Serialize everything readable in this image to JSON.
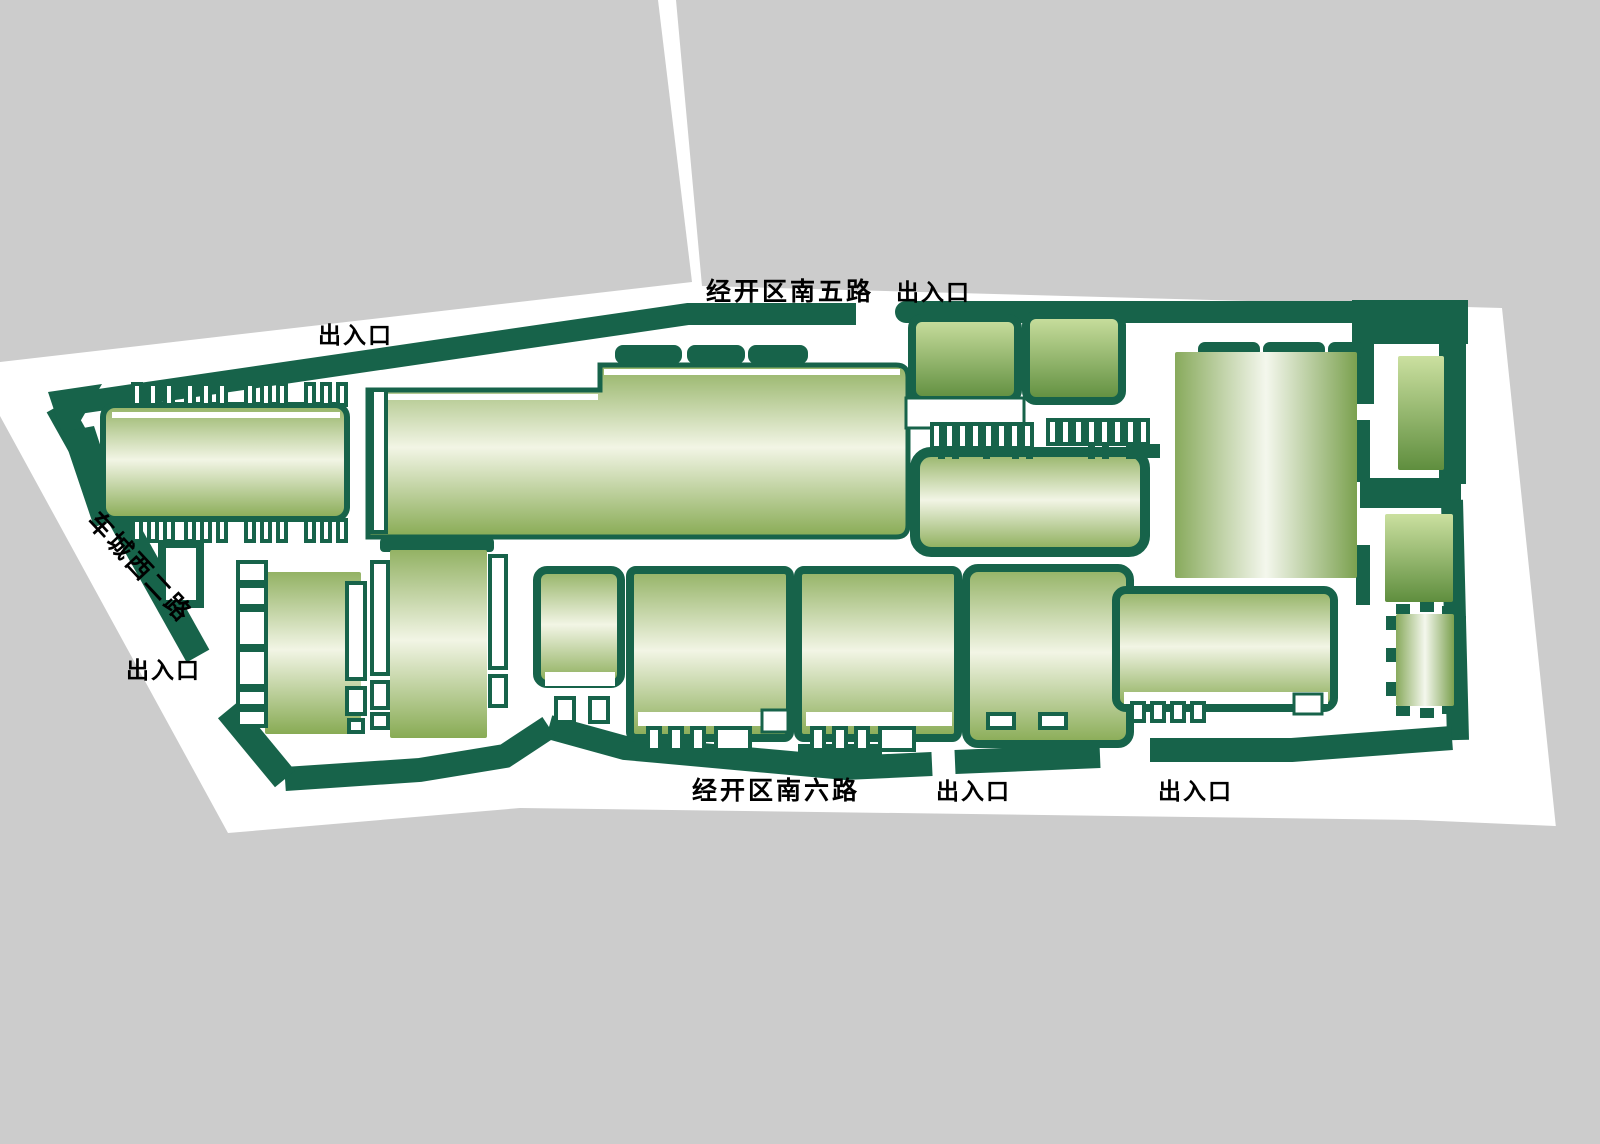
{
  "map": {
    "title": "industrial-park-site-plan",
    "roads": {
      "top": "经开区南五路",
      "bottom": "经开区南六路",
      "left": "车城西二路"
    },
    "entrance_label": "出入口",
    "colors": {
      "background": "#ffffff",
      "city_block_gray": "#cccccc",
      "site_green": "#17634a",
      "building_border": "#17634a",
      "label_text": "#000000",
      "gradient_vertical": {
        "edge_top": "#93b264",
        "middle": "#f2f5e5",
        "edge_bottom": "#88ab54"
      },
      "gradient_shaded": {
        "top": "#cbe0a0",
        "bottom": "#5f8e3e"
      },
      "gradient_horizontal": {
        "left": "#88aa5c",
        "middle": "#f4f7ed",
        "right": "#7ba14f"
      }
    }
  }
}
